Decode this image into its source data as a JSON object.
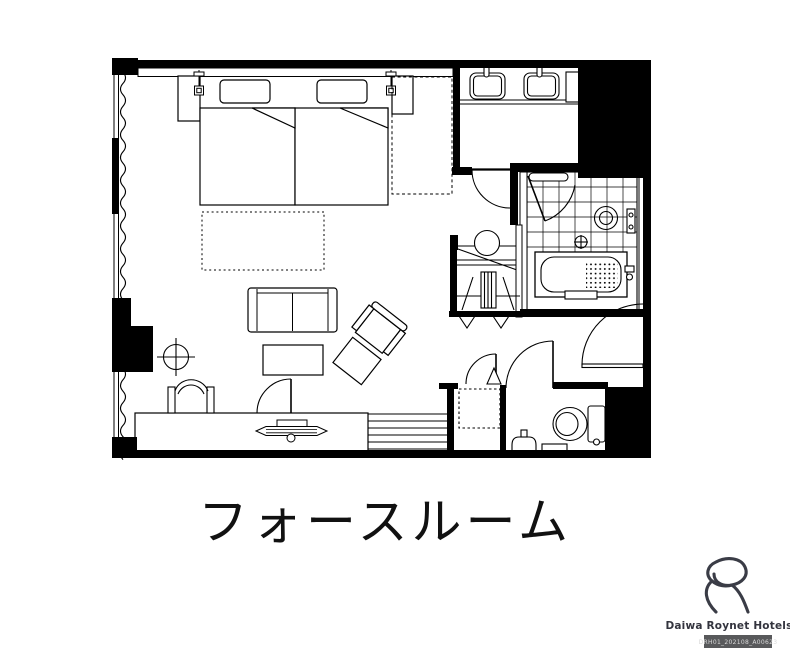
{
  "page": {
    "background": "#ffffff"
  },
  "floor_plan": {
    "title": "フォースルーム",
    "ink_color": "#000000"
  },
  "branding": {
    "name": "Daiwa Roynet Hotels",
    "code": "DRH01_202108_A00623",
    "badge_bg": "#58595B",
    "badge_text_color": "#D8D8D8",
    "logo_color": "#3A3C46",
    "name_color": "#33343E"
  }
}
